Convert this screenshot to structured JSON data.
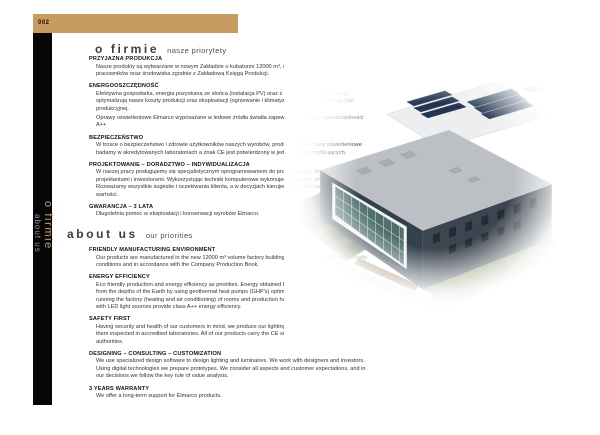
{
  "page": {
    "number": "002"
  },
  "colors": {
    "accent_gold": "#c69c60",
    "sidebar_black": "#060606",
    "body_text": "#333333"
  },
  "sidebar": {
    "title": "o firmie",
    "subtitle": "about us"
  },
  "header_pl": {
    "title": "o firmie",
    "subtitle": "nasze priorytety"
  },
  "header_en": {
    "title": "about us",
    "subtitle": "our priorities"
  },
  "sections_pl": [
    {
      "heading": "PRZYJAZNA PRODUKCJA",
      "body": "Nasze produkty są wytwarzane w nowym Zakładzie o kubaturze 12000 m³, w warunkach przyjaznych dla pracowników oraz środowiska zgodnie z Zakładową Księgą Produkcji."
    },
    {
      "heading": "ENERGOOSZCZĘDNOŚĆ",
      "body": "Efektywna gospodarka, energia pozyskana ze słońca (instalacja PV) oraz z głębi ziemi (pompy ciepła) optymalizują nasze koszty produkcji oraz eksploatacji (ogrzewanie i klimatyzację) pomieszczeń oraz hali produkcyjnej.",
      "body2": "Oprawy oświetleniowe Elmarco wyposażane w ledowe źródła światła zapewniają klasę energooszczędności A++"
    },
    {
      "heading": "BEZPIECZEŃSTWO",
      "body": "W trosce o bezpieczeństwo i zdrowie użytkowników naszych wyrobów, produkowane oprawy oświetleniowe badamy w akredytowanych laboratoriach a znak CE jest potwierdzony w jednostkach certyfikujących."
    },
    {
      "heading": "PROJEKTOWANIE – DORADZTWO – INDYWIDUALIZACJA",
      "body": "W naszej pracy posługujemy się specjalistycznym oprogramowaniem do projektowania. Współpracujemy z projektantami i inwestorami. Wykorzystując techniki komputerowe wykonujemy projekty oświetlenia oraz opraw. Rozważamy wszystkie sugestie i oczekiwania klienta, a w decyzjach kierujemy się złotą zasadą analizy wartości."
    },
    {
      "heading": "GWARANCJA – 3 LATA",
      "body": "Długoletnia pomoc w eksploatacji i konserwacji wyrobów Elmarco."
    }
  ],
  "sections_en": [
    {
      "heading": "FRIENDLY MANUFACTURING ENVIRONMENT",
      "body": "Our products are manufactured in the new 12000 m³ volume factory building, in environment and staff friendly conditions and in accordance with the Company Production Book."
    },
    {
      "heading": "ENERGY EFFICIENCY",
      "body": "Eco friendly production and energy efficiency as priorities. Energy obtained from the Sun (PV installation) and from the depths of the Earth by using geothermal heat pumps (GHP's) optimise our costs of production and running the factory (heating and air conditioning) of rooms and production hall. Elmarco luminaires equipped with LED light sources provide class A++ energy efficiency."
    },
    {
      "heading": "SAFETY FIRST",
      "body": "Having security and health of our customers in mind, we produce our lighting fixtures with thoroughness and get them inspected in accredited laboratories. All of our products carry the CE sign issued by respectful certification authorities."
    },
    {
      "heading": "DESIGNING – CONSULTING – CUSTOMIZATION",
      "body": "We use specialized design software to design lighting and luminaires. We work with designers and investors. Using digital technologies we prepare prototypes. We consider all aspects and customer expectations, and in our decisions we follow the key rule of value analysis."
    },
    {
      "heading": "3 YEARS WARRANTY",
      "body": "We offer a long-term support for Elmarco products."
    }
  ],
  "image": {
    "name": "factory-aerial-photo"
  }
}
